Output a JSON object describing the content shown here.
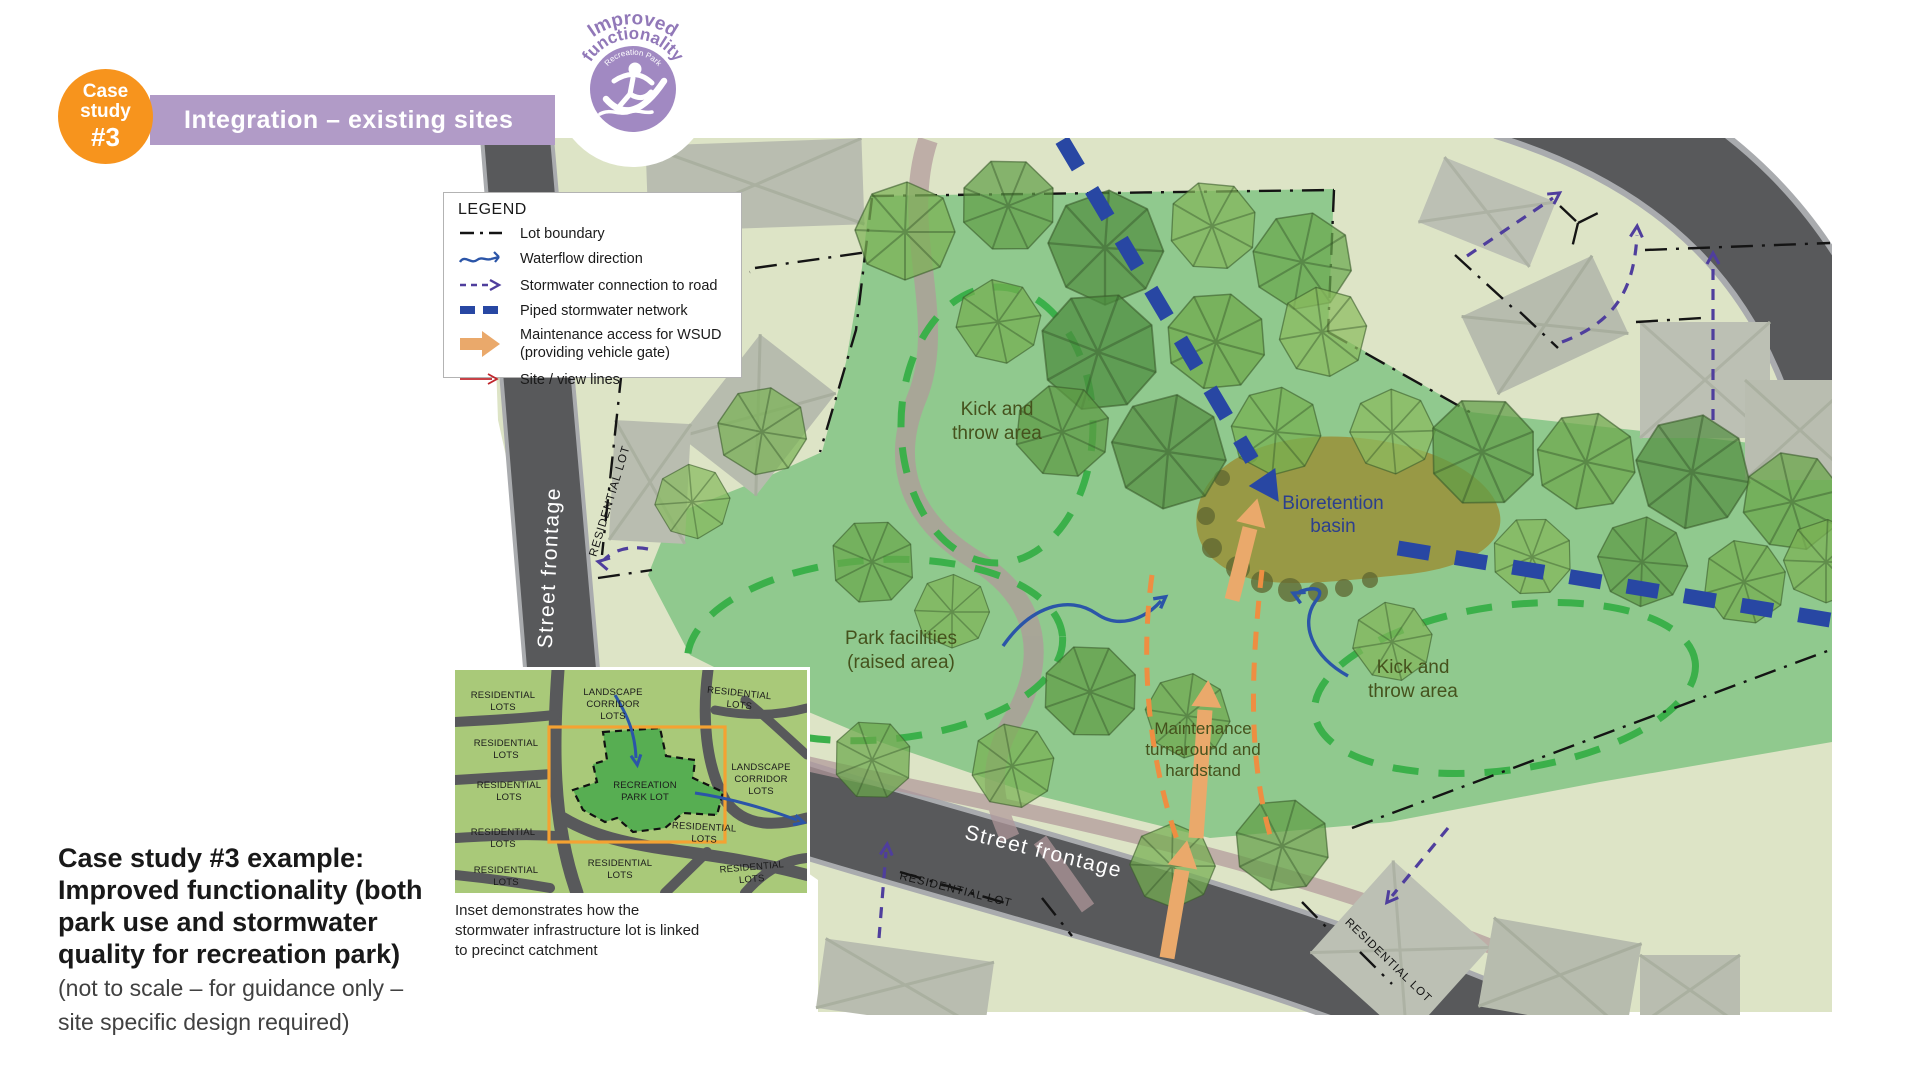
{
  "header": {
    "badge": {
      "line1": "Case",
      "line2": "study",
      "line3": "#3"
    },
    "banner_title": "Integration – existing sites",
    "stamp": {
      "arc_line1": "Improved",
      "arc_line2": "functionality",
      "arc_line3": "Recreation Park"
    }
  },
  "legend": {
    "title": "LEGEND",
    "items": [
      {
        "icon": "lot-boundary",
        "label": "Lot boundary"
      },
      {
        "icon": "waterflow",
        "label": "Waterflow direction"
      },
      {
        "icon": "stormwater-connection",
        "label": "Stormwater connection to road"
      },
      {
        "icon": "piped-network",
        "label": "Piped stormwater network"
      },
      {
        "icon": "maintenance-access",
        "label": "Maintenance access for WSUD",
        "label2": "(providing vehicle gate)"
      },
      {
        "icon": "site-view-lines",
        "label": "Site / view lines"
      }
    ]
  },
  "map": {
    "labels": {
      "kick_throw_1": [
        "Kick and",
        "throw area"
      ],
      "bioretention": [
        "Bioretention",
        "basin"
      ],
      "park_facilities": [
        "Park facilities",
        "(raised area)"
      ],
      "maintenance": [
        "Maintenance",
        "turnaround and",
        "hardstand"
      ],
      "kick_throw_2": [
        "Kick and",
        "throw area"
      ],
      "street_frontage_left": "Street frontage",
      "street_frontage_bottom": "Street frontage",
      "residential_lot_left": "RESIDENTIAL LOT",
      "residential_lot_bottom": "RESIDENTIAL LOT",
      "residential_lot_right": "RESIDENTIAL LOT"
    }
  },
  "inset": {
    "labels": [
      {
        "lines": [
          "RESIDENTIAL",
          "LOTS"
        ]
      },
      {
        "lines": [
          "RESIDENTIAL",
          "LOTS"
        ]
      },
      {
        "lines": [
          "RESIDENTIAL",
          "LOTS"
        ]
      },
      {
        "lines": [
          "RESIDENTIAL",
          "LOTS"
        ]
      },
      {
        "lines": [
          "RESIDENTIAL",
          "LOTS"
        ]
      },
      {
        "lines": [
          "LANDSCAPE",
          "CORRIDOR",
          "LOTS"
        ]
      },
      {
        "lines": [
          "RESIDENTIAL",
          "LOTS"
        ]
      },
      {
        "lines": [
          "LANDSCAPE",
          "CORRIDOR",
          "LOTS"
        ]
      },
      {
        "lines": [
          "RECREATION",
          "PARK LOT"
        ]
      },
      {
        "lines": [
          "RESIDENTIAL",
          "LOTS"
        ]
      },
      {
        "lines": [
          "RESIDENTIAL",
          "LOTS"
        ]
      },
      {
        "lines": [
          "RESIDENTIAL",
          "LOTS"
        ]
      }
    ],
    "caption_lines": [
      "Inset demonstrates how the",
      "stormwater infrastructure lot is linked",
      "to precinct catchment"
    ]
  },
  "footer": {
    "title_lines": [
      "Case study #3 example:",
      "Improved functionality (both",
      "park use and stormwater",
      "quality for recreation park)"
    ],
    "note_lines": [
      "(not to scale – for guidance only –",
      "site specific design required)"
    ]
  },
  "colors": {
    "accent_orange": "#f7941d",
    "banner_purple": "#b19bc7",
    "stamp_purple": "#a189c2",
    "park_green": "#8cc88b",
    "pale_green": "#dde4c6",
    "road_gray": "#58595b",
    "pipe_blue": "#2847a3",
    "flow_blue": "#2b55a8",
    "connection_purple": "#4f3e9d",
    "maintenance_orange": "#eaa96b",
    "site_red": "#c0272d",
    "dashed_green": "#3bb04a",
    "basin_olive": "#9a9038"
  }
}
